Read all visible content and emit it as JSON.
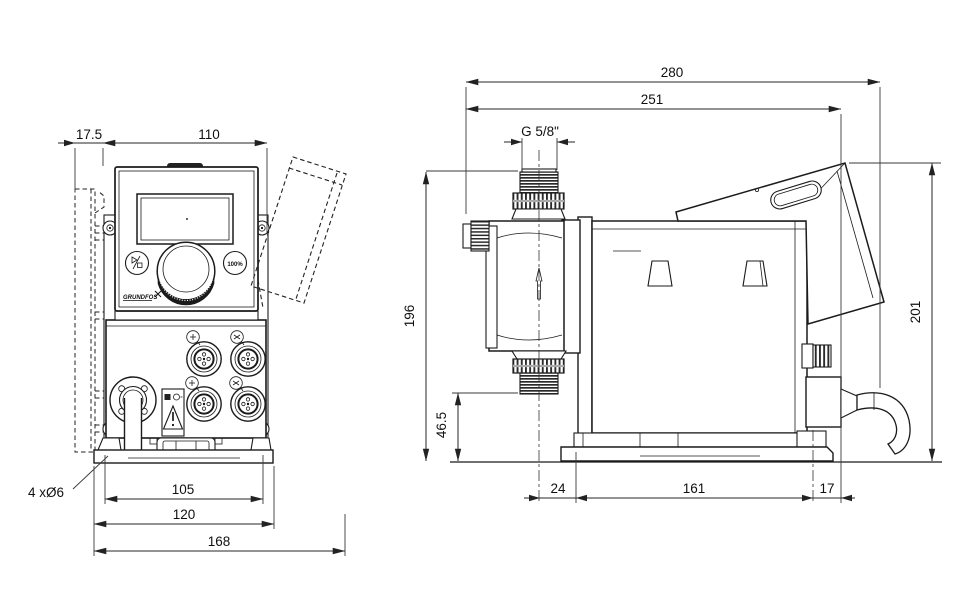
{
  "front_view": {
    "dims": {
      "wall_offset": "17.5",
      "panel_width": "110",
      "mounting_holes": "4 xØ6",
      "hole_spacing": "105",
      "base_width": "120",
      "overall_width": "168"
    },
    "panel": {
      "full_capacity_button": "100%",
      "brand": "GRUNDFOS"
    }
  },
  "side_view": {
    "dims": {
      "overall_depth": "280",
      "depth_to_cable_gland": "251",
      "connection_thread": "G 5/8\"",
      "discharge_height": "196",
      "suction_height": "46.5",
      "base_front_offset": "24",
      "base_length": "161",
      "base_rear_offset": "17",
      "overall_height": "201"
    }
  }
}
